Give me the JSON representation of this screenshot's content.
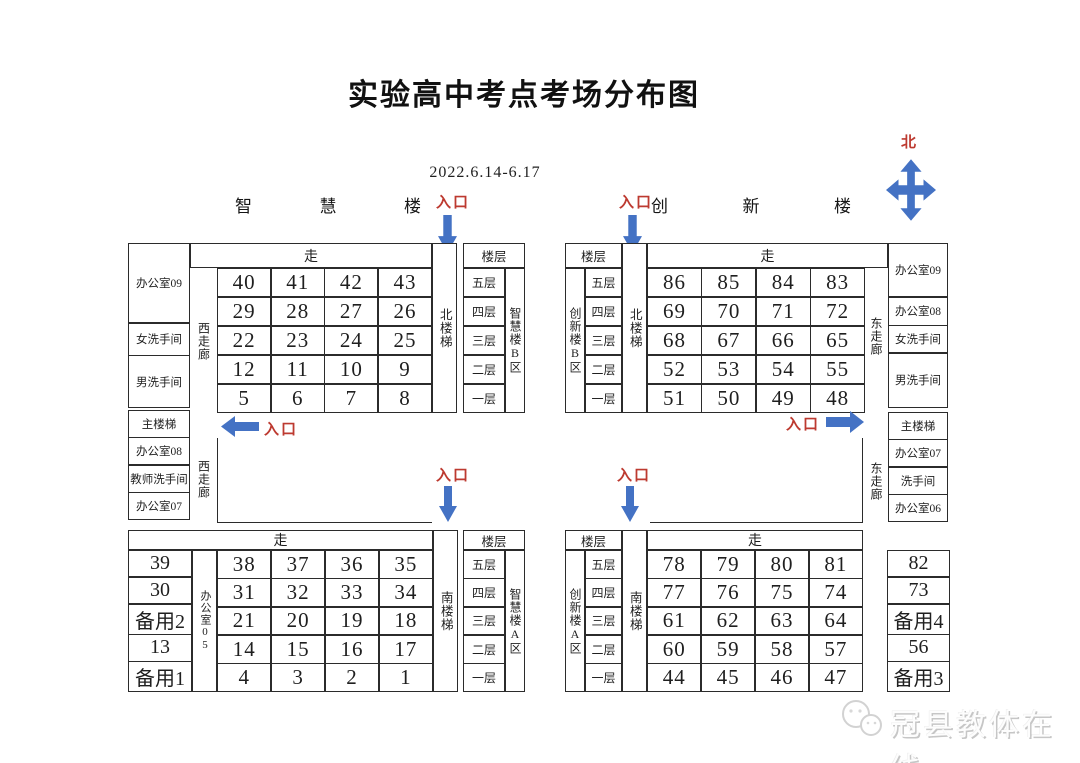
{
  "title": "实验高中考点考场分布图",
  "date_range": "2022.6.14-6.17",
  "compass": {
    "north": "北"
  },
  "labels": {
    "entrance": "入口",
    "corridor": "走",
    "floor_header": "楼层",
    "west_corridor": "西走廊",
    "east_corridor": "东走廊",
    "north_stairs": "北楼梯",
    "south_stairs": "南楼梯"
  },
  "buildings": {
    "wisdom": {
      "chars": [
        "智",
        "慧",
        "楼"
      ]
    },
    "innovation": {
      "chars": [
        "创",
        "新",
        "楼"
      ]
    }
  },
  "floors": [
    "五层",
    "四层",
    "三层",
    "二层",
    "一层"
  ],
  "top_left": {
    "west_rooms": [
      "办公室09",
      "女洗手间",
      "男洗手间"
    ],
    "grid": [
      [
        "40",
        "41",
        "42",
        "43"
      ],
      [
        "29",
        "28",
        "27",
        "26"
      ],
      [
        "22",
        "23",
        "24",
        "25"
      ],
      [
        "12",
        "11",
        "10",
        "9"
      ],
      [
        "5",
        "6",
        "7",
        "8"
      ]
    ],
    "zone": "智慧楼B区"
  },
  "top_right": {
    "zone": "创新楼B区",
    "grid": [
      [
        "86",
        "85",
        "84",
        "83"
      ],
      [
        "69",
        "70",
        "71",
        "72"
      ],
      [
        "68",
        "67",
        "66",
        "65"
      ],
      [
        "52",
        "53",
        "54",
        "55"
      ],
      [
        "51",
        "50",
        "49",
        "48"
      ]
    ],
    "east_rooms": [
      "办公室09",
      "办公室08",
      "女洗手间",
      "男洗手间"
    ]
  },
  "mid_left_rooms": [
    "主楼梯",
    "办公室08",
    "教师洗手间",
    "办公室07"
  ],
  "mid_right_rooms": [
    "主楼梯",
    "办公室07",
    "洗手间",
    "办公室06"
  ],
  "bottom_left": {
    "west_cells": [
      "39",
      "30",
      "备用2",
      "13",
      "备用1"
    ],
    "office_col": "办公室05",
    "grid": [
      [
        "38",
        "37",
        "36",
        "35"
      ],
      [
        "31",
        "32",
        "33",
        "34"
      ],
      [
        "21",
        "20",
        "19",
        "18"
      ],
      [
        "14",
        "15",
        "16",
        "17"
      ],
      [
        "4",
        "3",
        "2",
        "1"
      ]
    ],
    "zone": "智慧楼A区"
  },
  "bottom_right": {
    "zone": "创新楼A区",
    "grid": [
      [
        "78",
        "79",
        "80",
        "81"
      ],
      [
        "77",
        "76",
        "75",
        "74"
      ],
      [
        "61",
        "62",
        "63",
        "64"
      ],
      [
        "60",
        "59",
        "58",
        "57"
      ],
      [
        "44",
        "45",
        "46",
        "47"
      ]
    ],
    "east_cells": [
      "82",
      "73",
      "备用4",
      "56",
      "备用3"
    ]
  },
  "watermark": {
    "text": "冠县教体在线"
  },
  "colors": {
    "arrow_blue": "#4472c4",
    "entrance_red": "#bd3a30",
    "border": "#2b2b2b",
    "ink": "#1f1f1f",
    "watermark_gray": "#c6c6c6"
  }
}
